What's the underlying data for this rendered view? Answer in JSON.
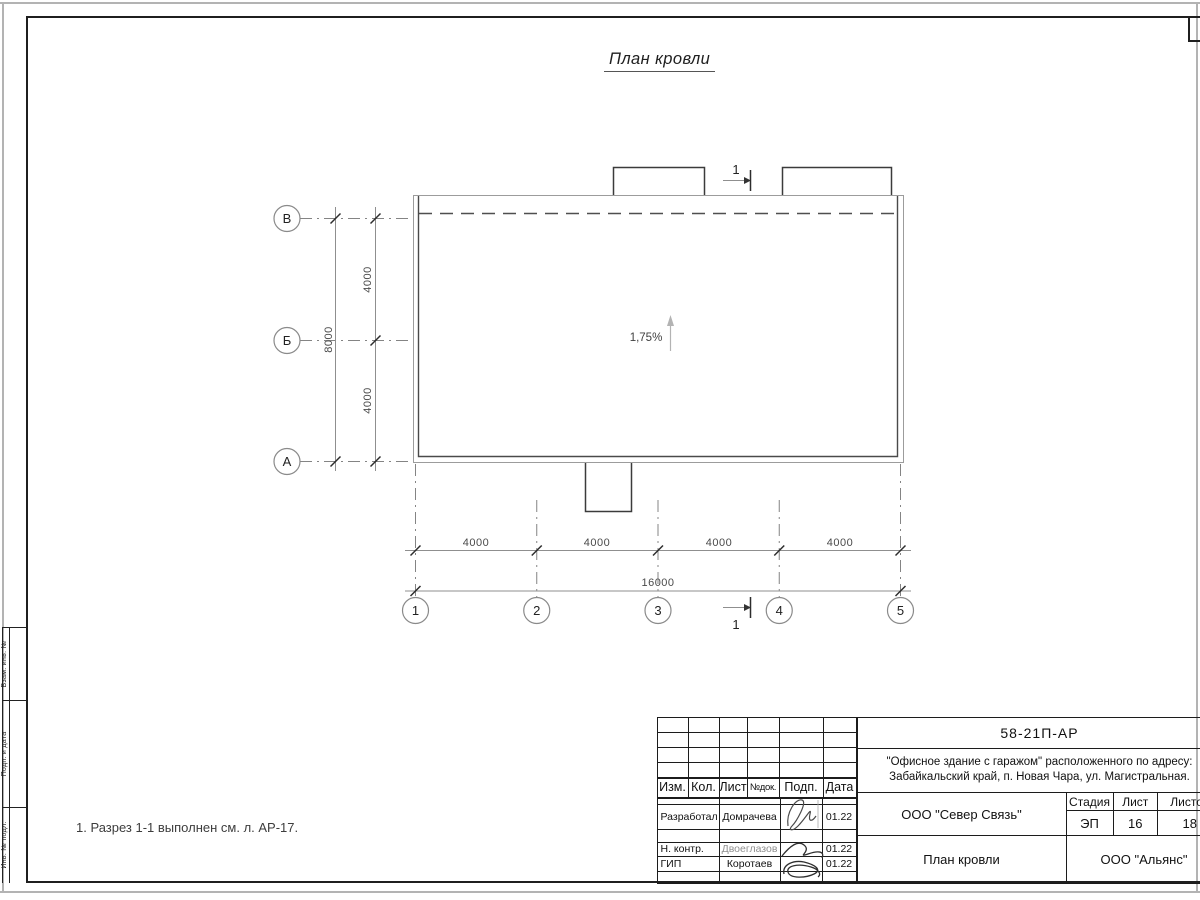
{
  "sheet": {
    "title": "План кровли",
    "note": "1. Разрез 1-1 выполнен см. л. АР-17."
  },
  "plan": {
    "slope": "1,75%",
    "section_label": "1",
    "row_axes": [
      "В",
      "Б",
      "А"
    ],
    "col_axes": [
      "1",
      "2",
      "3",
      "4",
      "5"
    ],
    "v_dims": [
      "4000",
      "4000"
    ],
    "v_total": "8000",
    "h_dims": [
      "4000",
      "4000",
      "4000",
      "4000"
    ],
    "h_total": "16000"
  },
  "side_stamp": {
    "labels": [
      "Взам. инв. №",
      "Подп. и дата",
      "Инв. № подл."
    ]
  },
  "title_block": {
    "doc_number": "58-21П-АР",
    "project_address_line1": "\"Офисное здание с гаражом\" расположенного по адресу:",
    "project_address_line2": "Забайкальский край, п. Новая Чара, ул. Магистральная.",
    "header_columns": [
      "Изм.",
      "Кол.",
      "Лист",
      "№док.",
      "Подп.",
      "Дата"
    ],
    "signers": [
      {
        "role": "Разработал",
        "name": "Домрачева",
        "date": "01.22"
      },
      {
        "role": "Н. контр.",
        "name": "Двоеглазов",
        "date": "01.22"
      },
      {
        "role": "ГИП",
        "name": "Коротаев",
        "date": "01.22"
      }
    ],
    "contractor": "ООО \"Север Связь\"",
    "drawing_name": "План кровли",
    "stage_label": "Стадия",
    "sheet_label": "Лист",
    "sheets_label": "Листов",
    "stage": "ЭП",
    "sheet_no": "16",
    "sheets_total": "18",
    "company": "ООО \"Альянс\""
  }
}
